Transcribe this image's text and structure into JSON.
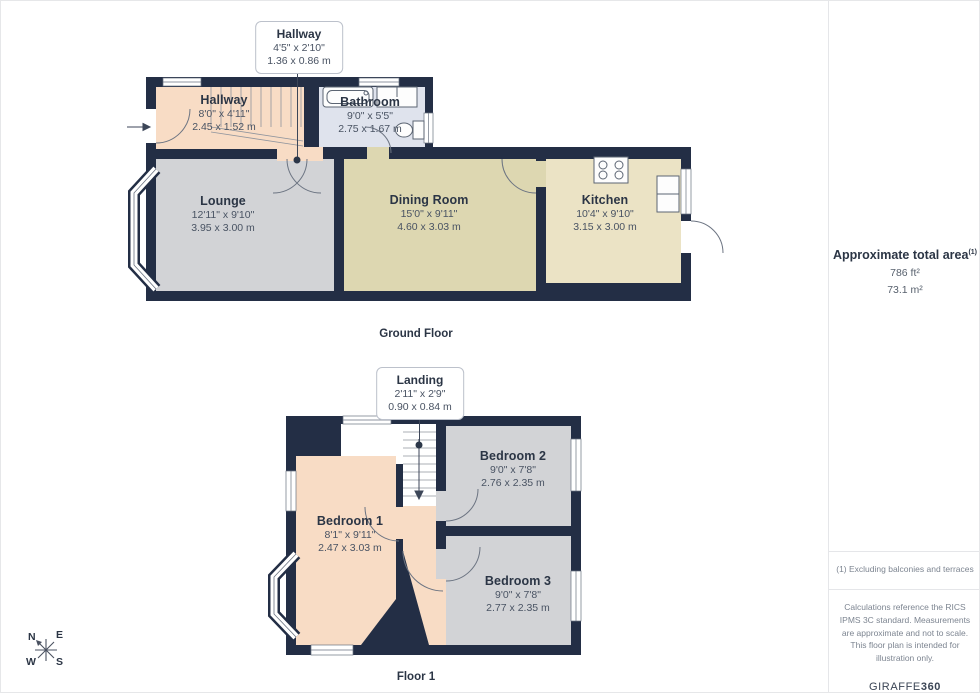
{
  "colors": {
    "wall": "#232e45",
    "peach": "#f8dcc5",
    "gray": "#d2d3d6",
    "blue": "#dfe3ed",
    "khaki": "#ddd7b1",
    "cream": "#ebe3c5",
    "ink": "#2b3545",
    "dims": "#495363",
    "muted": "#7d8591",
    "line": "#e5e6e9"
  },
  "ground_floor": {
    "label": "Ground Floor",
    "callout": {
      "title": "Hallway",
      "imperial": "4'5\" x 2'10\"",
      "metric": "1.36 x 0.86 m"
    },
    "rooms": {
      "hallway": {
        "name": "Hallway",
        "imperial": "8'0\" x 4'11\"",
        "metric": "2.45 x 1.52 m"
      },
      "bathroom": {
        "name": "Bathroom",
        "imperial": "9'0\" x 5'5\"",
        "metric": "2.75 x 1.67 m"
      },
      "lounge": {
        "name": "Lounge",
        "imperial": "12'11\" x 9'10\"",
        "metric": "3.95 x 3.00 m"
      },
      "dining_room": {
        "name": "Dining Room",
        "imperial": "15'0\" x 9'11\"",
        "metric": "4.60 x 3.03 m"
      },
      "kitchen": {
        "name": "Kitchen",
        "imperial": "10'4\" x 9'10\"",
        "metric": "3.15 x 3.00 m"
      }
    }
  },
  "floor_1": {
    "label": "Floor 1",
    "callout": {
      "title": "Landing",
      "imperial": "2'11\" x 2'9\"",
      "metric": "0.90 x 0.84 m"
    },
    "rooms": {
      "bedroom_1": {
        "name": "Bedroom 1",
        "imperial": "8'1\" x 9'11\"",
        "metric": "2.47 x 3.03 m"
      },
      "bedroom_2": {
        "name": "Bedroom 2",
        "imperial": "9'0\" x 7'8\"",
        "metric": "2.76 x 2.35 m"
      },
      "bedroom_3": {
        "name": "Bedroom 3",
        "imperial": "9'0\" x 7'8\"",
        "metric": "2.77 x 2.35 m"
      }
    }
  },
  "sidebar": {
    "area_title": "Approximate total area",
    "area_footnote_marker": "(1)",
    "area_imperial": "786 ft²",
    "area_metric": "73.1 m²",
    "footnote": "(1) Excluding balconies and terraces",
    "disclaimer": "Calculations reference the RICS IPMS 3C standard. Measurements are approximate and not to scale. This floor plan is intended for illustration only.",
    "brand_name": "GIRAFFE",
    "brand_suffix": "360"
  },
  "compass": {
    "north": "N",
    "east": "E",
    "south": "S",
    "west": "W"
  }
}
